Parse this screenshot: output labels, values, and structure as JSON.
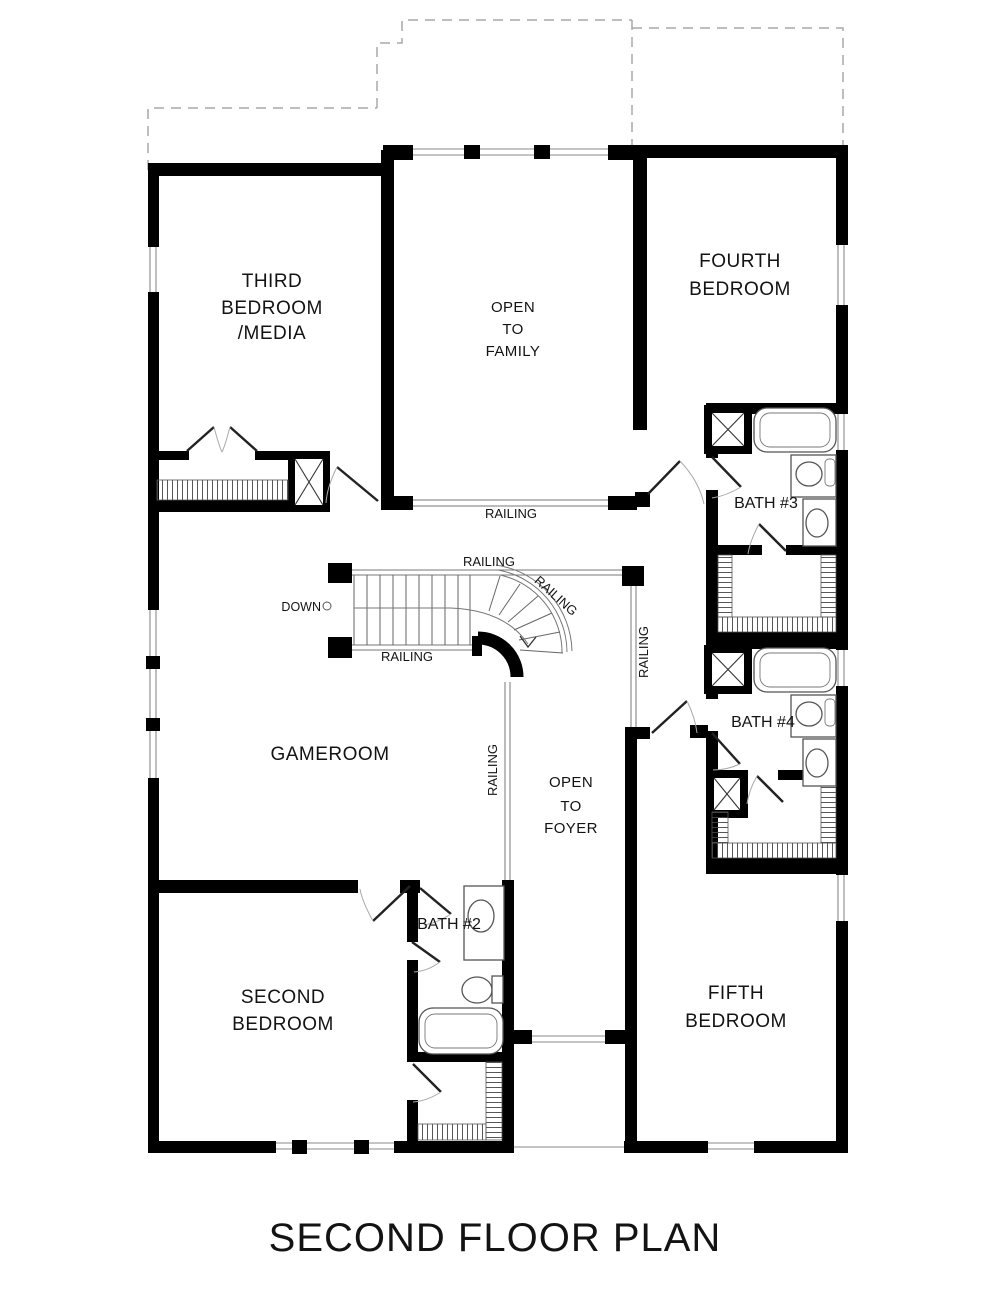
{
  "title": "SECOND FLOOR PLAN",
  "labels": {
    "railing": "RAILING",
    "down": "DOWN"
  },
  "rooms": {
    "third_bedroom": {
      "lines": [
        "THIRD",
        "BEDROOM",
        "/MEDIA"
      ]
    },
    "open_to_family": {
      "lines": [
        "OPEN",
        "TO",
        "FAMILY"
      ]
    },
    "fourth_bedroom": {
      "lines": [
        "FOURTH",
        "BEDROOM"
      ]
    },
    "gameroom": {
      "lines": [
        "GAMEROOM"
      ]
    },
    "open_to_foyer": {
      "lines": [
        "OPEN",
        "TO",
        "FOYER"
      ]
    },
    "second_bedroom": {
      "lines": [
        "SECOND",
        "BEDROOM"
      ]
    },
    "fifth_bedroom": {
      "lines": [
        "FIFTH",
        "BEDROOM"
      ]
    },
    "bath_2": {
      "label": "BATH #2"
    },
    "bath_3": {
      "label": "BATH #3"
    },
    "bath_4": {
      "label": "BATH #4"
    }
  },
  "colors": {
    "wall": "#000000",
    "thin_line": "#8a8a8a",
    "dashed_roof": "#a9a9a9",
    "text": "#131313",
    "background": "#ffffff"
  }
}
